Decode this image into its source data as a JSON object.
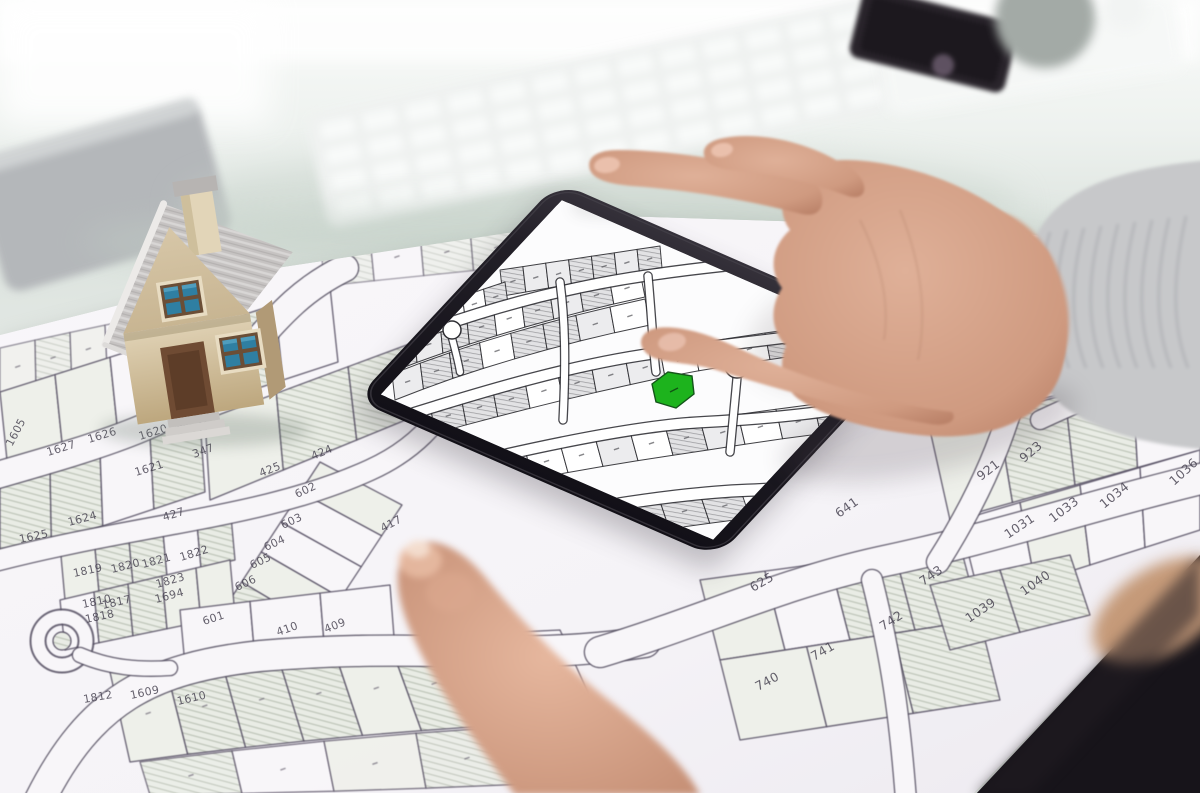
{
  "scene": {
    "colors": {
      "desk": "#e4eae5",
      "paper": "#f8f6f9",
      "parcel_line": "#575064",
      "parcel_hatch": "#b9c0b3",
      "house_wall": "#dccfb2",
      "house_roof": "#c6c3c2",
      "house_window": "#2f7fa2",
      "house_door": "#6f4b33",
      "tablet_bezel": "#201d24",
      "skin": "#d8a88f",
      "sleeve": "#c7c8ca",
      "lap_dark": "#17141a"
    }
  },
  "paper_map": {
    "parcel_labels": [
      {
        "t": "1605",
        "x": 12,
        "y": 447,
        "r": -62
      },
      {
        "t": "1627",
        "x": 48,
        "y": 456,
        "r": -17
      },
      {
        "t": "1626",
        "x": 89,
        "y": 443,
        "r": -17
      },
      {
        "t": "1620",
        "x": 140,
        "y": 440,
        "r": -17
      },
      {
        "t": "347",
        "x": 194,
        "y": 458,
        "r": -20
      },
      {
        "t": "1621",
        "x": 136,
        "y": 476,
        "r": -17
      },
      {
        "t": "425",
        "x": 261,
        "y": 477,
        "r": -22
      },
      {
        "t": "424",
        "x": 313,
        "y": 460,
        "r": -23
      },
      {
        "t": "602",
        "x": 297,
        "y": 498,
        "r": -25
      },
      {
        "t": "427",
        "x": 164,
        "y": 521,
        "r": -17
      },
      {
        "t": "1624",
        "x": 69,
        "y": 526,
        "r": -15
      },
      {
        "t": "1625",
        "x": 20,
        "y": 543,
        "r": -12
      },
      {
        "t": "603",
        "x": 283,
        "y": 529,
        "r": -25
      },
      {
        "t": "604",
        "x": 266,
        "y": 551,
        "r": -25
      },
      {
        "t": "605",
        "x": 252,
        "y": 569,
        "r": -25
      },
      {
        "t": "606",
        "x": 237,
        "y": 591,
        "r": -25
      },
      {
        "t": "417",
        "x": 383,
        "y": 532,
        "r": -28
      },
      {
        "t": "1822",
        "x": 181,
        "y": 561,
        "r": -17
      },
      {
        "t": "1821",
        "x": 143,
        "y": 568,
        "r": -15
      },
      {
        "t": "1820",
        "x": 112,
        "y": 573,
        "r": -14
      },
      {
        "t": "1819",
        "x": 74,
        "y": 577,
        "r": -12
      },
      {
        "t": "1823",
        "x": 157,
        "y": 588,
        "r": -16
      },
      {
        "t": "1694",
        "x": 156,
        "y": 603,
        "r": -15
      },
      {
        "t": "1810",
        "x": 83,
        "y": 608,
        "r": -12
      },
      {
        "t": "1817",
        "x": 103,
        "y": 609,
        "r": -13
      },
      {
        "t": "1818",
        "x": 86,
        "y": 623,
        "r": -12
      },
      {
        "t": "601",
        "x": 204,
        "y": 625,
        "r": -18
      },
      {
        "t": "410",
        "x": 278,
        "y": 636,
        "r": -20
      },
      {
        "t": "409",
        "x": 326,
        "y": 633,
        "r": -22
      },
      {
        "t": "1812",
        "x": 84,
        "y": 703,
        "r": -10
      },
      {
        "t": "1609",
        "x": 131,
        "y": 699,
        "r": -12
      },
      {
        "t": "1610",
        "x": 178,
        "y": 705,
        "r": -13
      },
      {
        "t": "641",
        "x": 839,
        "y": 518,
        "r": -35
      },
      {
        "t": "921",
        "x": 981,
        "y": 481,
        "r": -38
      },
      {
        "t": "923",
        "x": 1024,
        "y": 463,
        "r": -40
      },
      {
        "t": "1031",
        "x": 1008,
        "y": 539,
        "r": -34
      },
      {
        "t": "1033",
        "x": 1053,
        "y": 523,
        "r": -37
      },
      {
        "t": "1034",
        "x": 1104,
        "y": 509,
        "r": -39
      },
      {
        "t": "1036",
        "x": 1174,
        "y": 486,
        "r": -42
      },
      {
        "t": "743",
        "x": 923,
        "y": 586,
        "r": -34
      },
      {
        "t": "742",
        "x": 883,
        "y": 631,
        "r": -33
      },
      {
        "t": "741",
        "x": 814,
        "y": 661,
        "r": -30
      },
      {
        "t": "740",
        "x": 758,
        "y": 691,
        "r": -28
      },
      {
        "t": "1040",
        "x": 1024,
        "y": 596,
        "r": -35
      },
      {
        "t": "1039",
        "x": 969,
        "y": 623,
        "r": -34
      },
      {
        "t": "625",
        "x": 753,
        "y": 592,
        "r": -30
      }
    ]
  },
  "tablet": {
    "green_parcel_color": "#1db31d",
    "marker_color": "#f2a71b"
  }
}
